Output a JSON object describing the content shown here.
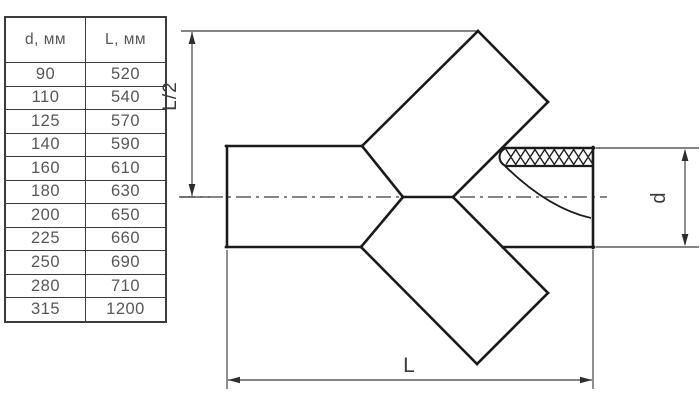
{
  "table": {
    "headers": [
      "d, мм",
      "L, мм"
    ],
    "rows": [
      {
        "d": "90",
        "L": "520"
      },
      {
        "d": "110",
        "L": "540"
      },
      {
        "d": "125",
        "L": "570"
      },
      {
        "d": "140",
        "L": "590"
      },
      {
        "d": "160",
        "L": "610"
      },
      {
        "d": "180",
        "L": "630"
      },
      {
        "d": "200",
        "L": "650"
      },
      {
        "d": "225",
        "L": "660"
      },
      {
        "d": "250",
        "L": "690"
      },
      {
        "d": "280",
        "L": "710"
      },
      {
        "d": "315",
        "L": "1200"
      }
    ]
  },
  "diagram": {
    "labels": {
      "half_length": "L/2",
      "length": "L",
      "diameter": "d"
    }
  },
  "colors": {
    "background": "#ffffff",
    "outline_ink": "#1b1b1d",
    "dimension_ink": "#3a3a3c",
    "table_text": "#57575a",
    "table_border": "#3c3c3e"
  }
}
